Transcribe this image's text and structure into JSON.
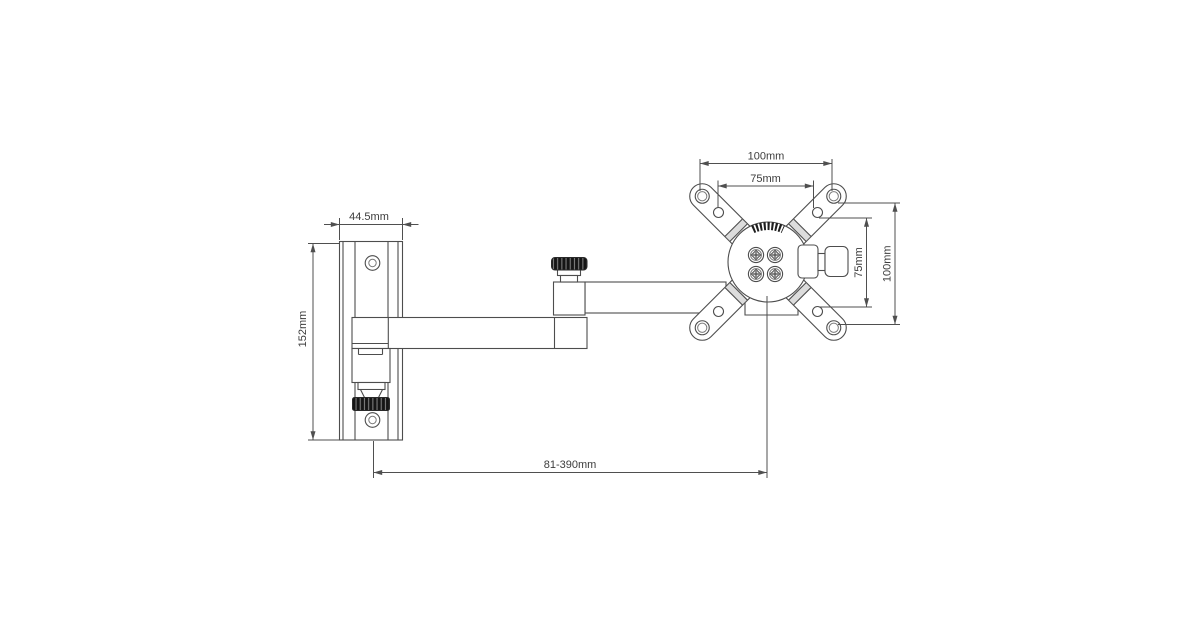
{
  "colors": {
    "background": "#ffffff",
    "part_line": "#4d4d4d",
    "dimension_line": "#4f4f4f",
    "label_text": "#3c3c3c",
    "knurl_dark": "#151515"
  },
  "dimensions": {
    "vesa_outer_width": "100mm",
    "vesa_inner_width": "75mm",
    "vesa_inner_height": "75mm",
    "vesa_outer_height": "100mm",
    "wall_plate_width": "44.5mm",
    "wall_plate_height": "152mm",
    "arm_extension_range": "81-390mm"
  }
}
